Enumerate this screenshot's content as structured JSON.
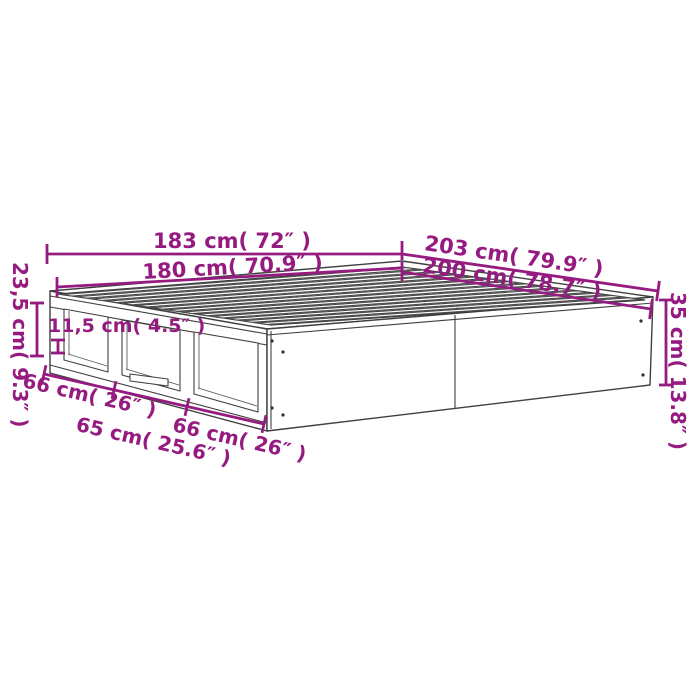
{
  "page": {
    "background": "#ffffff"
  },
  "drawing": {
    "subject": "storage-bed-frame-dimension-diagram",
    "colors": {
      "dimension_accent": "#951b81",
      "outline": "#3f3f3f",
      "surface": "#ffffff"
    },
    "labels": {
      "width_outer": "183 cm( 72″ )",
      "width_inner": "180 cm( 70.9″ )",
      "length_outer": "203 cm( 79.9″ )",
      "length_inner": "200 cm( 78.7″ )",
      "side_height": "23,5 cm( 9.3″ )",
      "opening_height": "11,5 cm( 4.5″ )",
      "total_height": "35 cm( 13.8″ )",
      "section_left": "66 cm( 26″ )",
      "section_middle": "65 cm( 25.6″ )",
      "section_right": "66 cm( 26″ )"
    }
  }
}
